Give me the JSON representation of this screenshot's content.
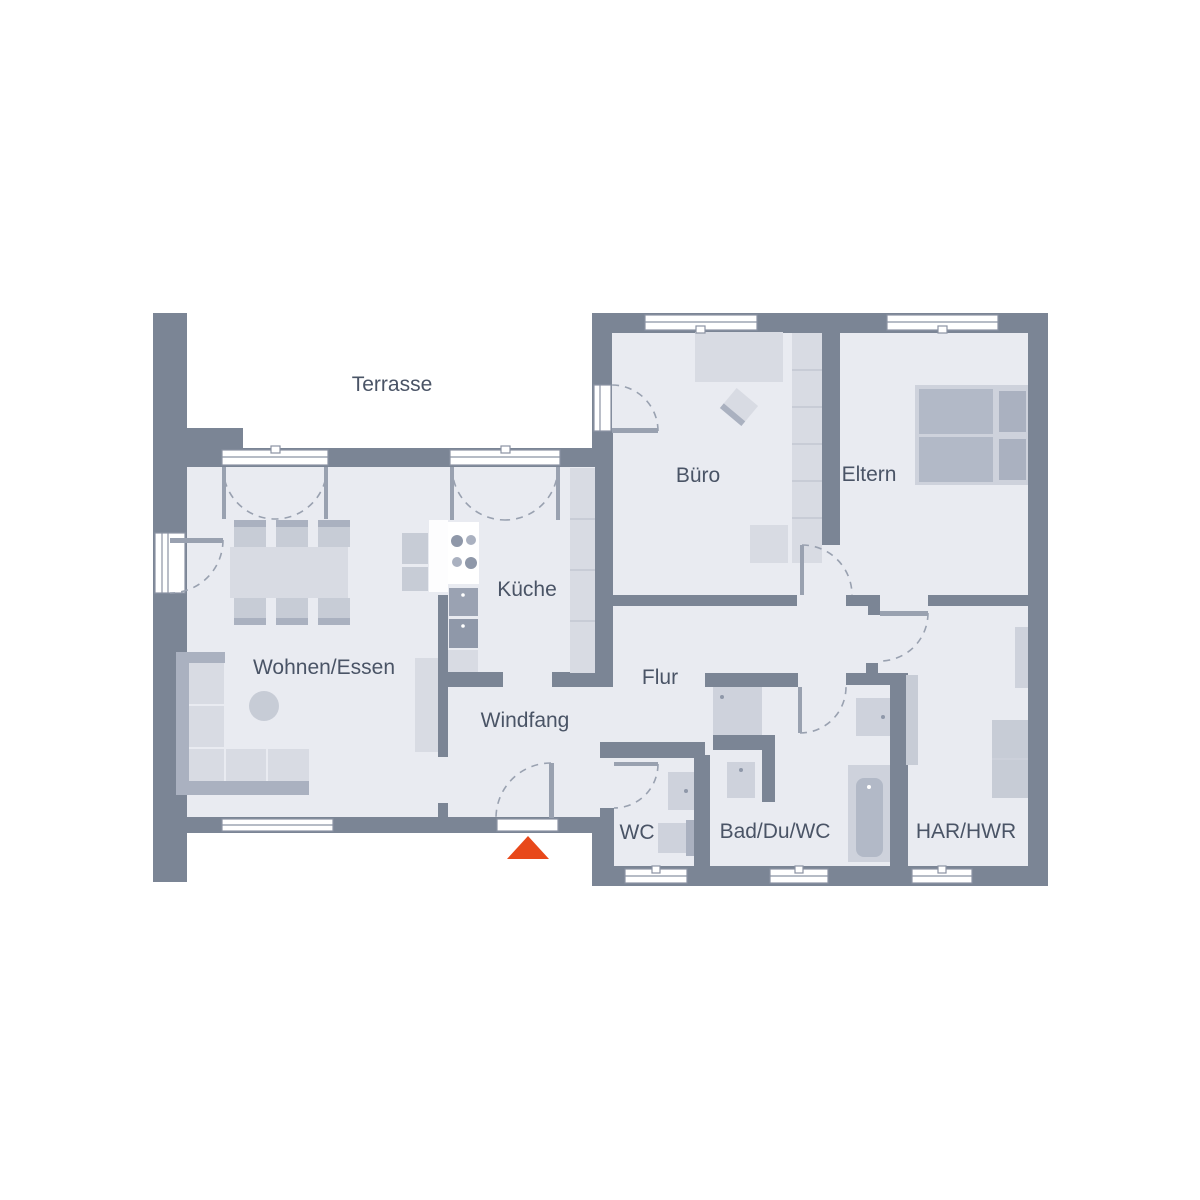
{
  "title": "Grundriss Bungalow",
  "colors": {
    "wall": "#7b8595",
    "floor": "#e9ebf1",
    "label": "#4a5466",
    "furn-light": "#d8dbe3",
    "furn-mid": "#c7ccd6",
    "furn-dark": "#aab1c0",
    "mattress": "#b2b9c7",
    "appliance": "#8f98a9",
    "appliance2": "#9aa2b2",
    "fixture": "#ced2dc",
    "door": "#99a1b0",
    "window-line": "#8b93a3",
    "divider-line": "#c3c8d2",
    "entrance-marker": "#e8481a"
  },
  "rooms": [
    {
      "id": "terrasse",
      "label": "Terrasse",
      "x": 392,
      "y": 391
    },
    {
      "id": "buero",
      "label": "Büro",
      "x": 698,
      "y": 482
    },
    {
      "id": "eltern",
      "label": "Eltern",
      "x": 869,
      "y": 481
    },
    {
      "id": "kueche",
      "label": "Küche",
      "x": 527,
      "y": 596
    },
    {
      "id": "wohnen",
      "label": "Wohnen/Essen",
      "x": 324,
      "y": 674
    },
    {
      "id": "flur",
      "label": "Flur",
      "x": 660,
      "y": 684
    },
    {
      "id": "windfang",
      "label": "Windfang",
      "x": 525,
      "y": 727
    },
    {
      "id": "wc",
      "label": "WC",
      "x": 637,
      "y": 839
    },
    {
      "id": "bad",
      "label": "Bad/Du/WC",
      "x": 775,
      "y": 838
    },
    {
      "id": "har",
      "label": "HAR/HWR",
      "x": 966,
      "y": 838
    }
  ],
  "entrance": {
    "icon": "entrance-arrow",
    "description": "Eingang"
  }
}
